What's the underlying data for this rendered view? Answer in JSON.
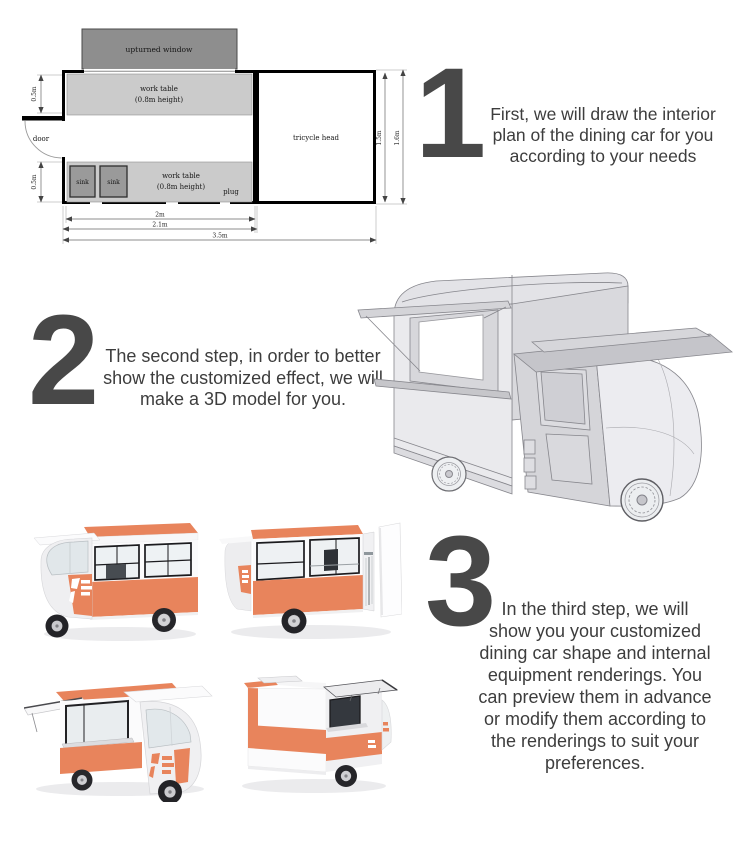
{
  "colors": {
    "accent_orange": "#e8845c",
    "number_gray": "#484848",
    "text_gray": "#3d3d3d",
    "plan_window_gray": "#8e8e8e",
    "plan_table_gray": "#cbcbcb",
    "plan_sink_gray": "#9a9a9a"
  },
  "steps": [
    {
      "number": "1",
      "lines": [
        "First, we will draw the interior",
        "plan of the dining car for you",
        "according to your needs"
      ]
    },
    {
      "number": "2",
      "lines": [
        "The second step, in order to better",
        "show the customized effect, we will",
        "make a 3D model for you."
      ]
    },
    {
      "number": "3",
      "lines": [
        "In the third step, we will",
        "show you your customized",
        "dining car shape and internal",
        "equipment renderings. You",
        "can preview them in advance",
        "or modify them according to",
        "the renderings to suit your",
        "preferences."
      ]
    }
  ],
  "floorplan": {
    "upturned_window": "upturned window",
    "work_table_top": {
      "line1": "work table",
      "line2": "(0.8m height)"
    },
    "work_table_bottom": {
      "line1": "work table",
      "line2": "(0.8m height)"
    },
    "door": "door",
    "sink_left": "sink",
    "sink_right": "sink",
    "tricycle_head": "tricycle head",
    "plug": "plug",
    "dims": {
      "left_top": "0.5m",
      "left_bottom": "0.5m",
      "bottom_inner": "2m",
      "bottom_middle": "2.1m",
      "bottom_outer": "3.5m",
      "right_inner": "1.5m",
      "right_outer": "1.6m"
    }
  }
}
